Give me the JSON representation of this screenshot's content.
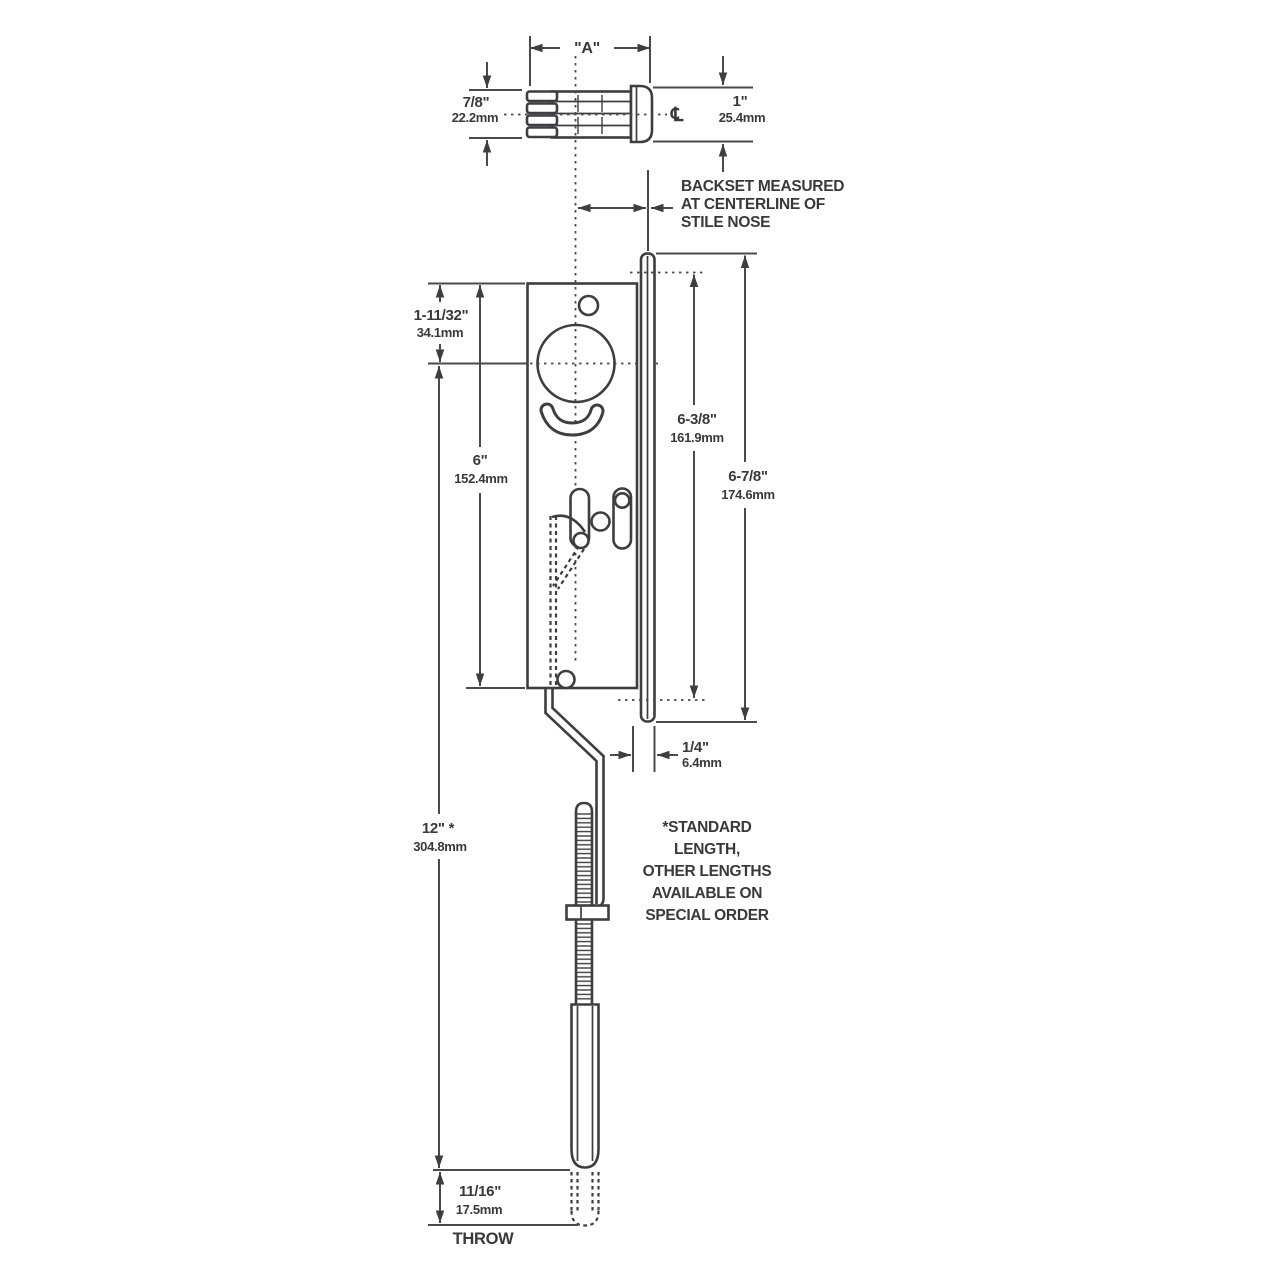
{
  "colors": {
    "line": "#3e3e42",
    "text": "#39393d",
    "background": "#ffffff"
  },
  "top_view": {
    "width": "\"A\"",
    "left_in": "7/8\"",
    "left_mm": "22.2mm",
    "right_in": "1\"",
    "right_mm": "25.4mm",
    "centerline_symbol": "℄"
  },
  "backset_note": [
    "BACKSET MEASURED",
    "AT CENTERLINE OF",
    "STILE NOSE"
  ],
  "dimensions": {
    "faceplate_top_to_center_in": "1-11/32\"",
    "faceplate_top_to_center_mm": "34.1mm",
    "faceplate_height_in": "6\"",
    "faceplate_height_mm": "152.4mm",
    "stile_inner_in": "6-3/8\"",
    "stile_inner_mm": "161.9mm",
    "stile_outer_in": "6-7/8\"",
    "stile_outer_mm": "174.6mm",
    "nose_offset_in": "1/4\"",
    "nose_offset_mm": "6.4mm",
    "rod_length_in": "12\" *",
    "rod_length_mm": "304.8mm",
    "throw_in": "11/16\"",
    "throw_mm": "17.5mm"
  },
  "labels": {
    "throw": "THROW"
  },
  "length_note": [
    "*STANDARD",
    "LENGTH,",
    "OTHER LENGTHS",
    "AVAILABLE ON",
    "SPECIAL ORDER"
  ]
}
